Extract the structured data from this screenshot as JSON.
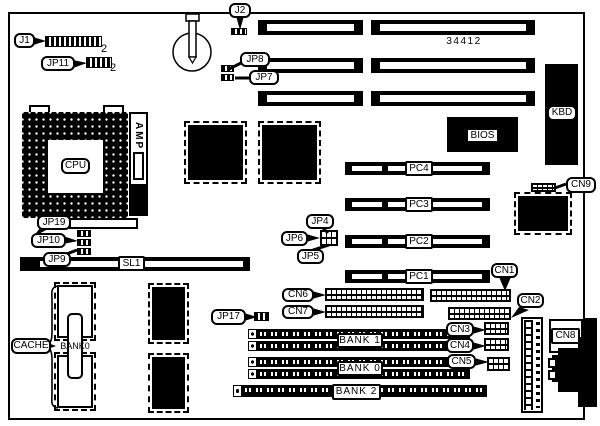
{
  "board": {
    "part_number": "34412"
  },
  "colors": {
    "ink": "#000000",
    "bg": "#ffffff"
  },
  "callouts": {
    "j1": "J1",
    "jp11": "JP11",
    "j2": "J2",
    "jp8": "JP8",
    "jp7": "JP7",
    "jp19": "JP19",
    "jp10": "JP10",
    "jp9": "JP9",
    "jp17": "JP17",
    "jp4": "JP4",
    "jp6": "JP6",
    "jp5": "JP5",
    "cn1": "CN1",
    "cn2": "CN2",
    "cn3": "CN3",
    "cn4": "CN4",
    "cn5": "CN5",
    "cn6": "CN6",
    "cn7": "CN7",
    "cn8": "CN8",
    "cn9": "CN9",
    "cache": "CACHE"
  },
  "pin_numbers": {
    "j1": "2",
    "jp11": "2"
  },
  "slots": {
    "pci": [
      "PC4",
      "PC3",
      "PC2",
      "PC1"
    ],
    "sl1": "SL1"
  },
  "chips": {
    "cpu": "CPU",
    "amp": "AMP",
    "bios": "BIOS",
    "kbd": "KBD"
  },
  "memory": {
    "cache_bank": "BANK0",
    "bank1": "BANK 1",
    "bank0": "BANK 0",
    "bank2": "BANK 2"
  }
}
